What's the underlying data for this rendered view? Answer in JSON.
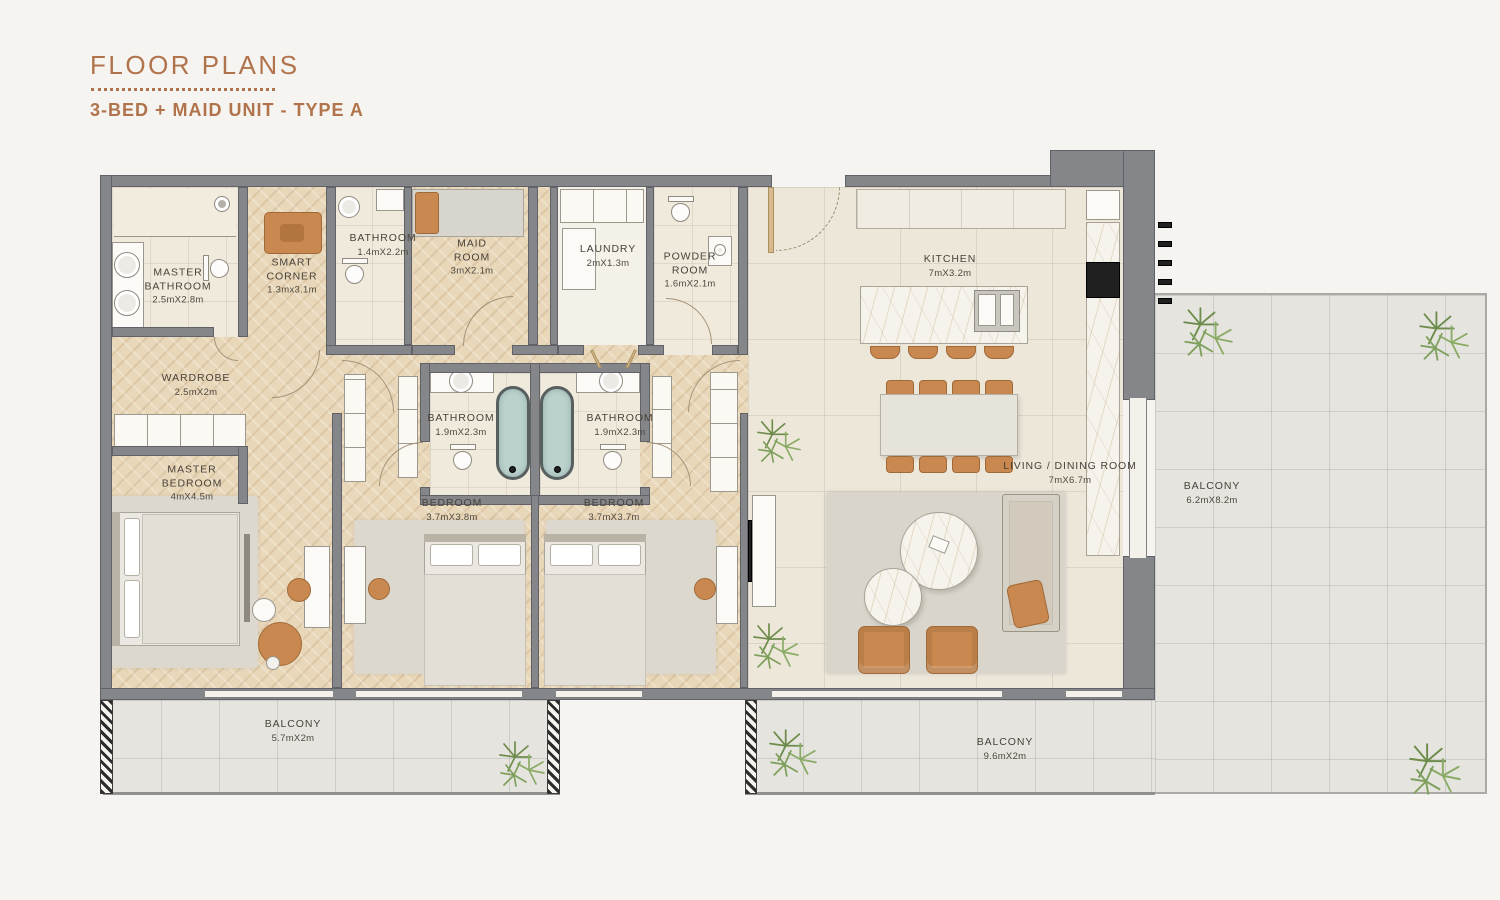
{
  "header": {
    "title": "FLOOR PLANS",
    "subtitle": "3-BED + MAID UNIT - TYPE A"
  },
  "floor_plan": {
    "rooms": [
      {
        "id": "master-bathroom",
        "name": "MASTER BATHROOM",
        "dims": "2.5mX2.8m"
      },
      {
        "id": "smart-corner",
        "name": "SMART CORNER",
        "dims": "1.3mx3.1m"
      },
      {
        "id": "bathroom-maid",
        "name": "BATHROOM",
        "dims": "1.4mX2.2m"
      },
      {
        "id": "maid-room",
        "name": "MAID ROOM",
        "dims": "3mX2.1m"
      },
      {
        "id": "laundry",
        "name": "LAUNDRY",
        "dims": "2mX1.3m"
      },
      {
        "id": "powder-room",
        "name": "POWDER ROOM",
        "dims": "1.6mX2.1m"
      },
      {
        "id": "kitchen",
        "name": "KITCHEN",
        "dims": "7mX3.2m"
      },
      {
        "id": "wardrobe",
        "name": "WARDROBE",
        "dims": "2.5mX2m"
      },
      {
        "id": "bathroom-1",
        "name": "BATHROOM",
        "dims": "1.9mX2.3m"
      },
      {
        "id": "bathroom-2",
        "name": "BATHROOM",
        "dims": "1.9mX2.3m"
      },
      {
        "id": "master-bedroom",
        "name": "MASTER BEDROOM",
        "dims": "4mX4.5m"
      },
      {
        "id": "bedroom-1",
        "name": "BEDROOM",
        "dims": "3.7mX3.8m"
      },
      {
        "id": "bedroom-2",
        "name": "BEDROOM",
        "dims": "3.7mX3.7m"
      },
      {
        "id": "living-dining",
        "name": "LIVING / DINING ROOM",
        "dims": "7mX6.7m"
      },
      {
        "id": "balcony-right",
        "name": "BALCONY",
        "dims": "6.2mX8.2m"
      },
      {
        "id": "balcony-left",
        "name": "BALCONY",
        "dims": "5.7mX2m"
      },
      {
        "id": "balcony-middle",
        "name": "BALCONY",
        "dims": "9.6mX2m"
      }
    ],
    "colors": {
      "accent": "#b0734c",
      "wall": "#84868a",
      "wood_floor": "#e9d7b9",
      "tile_floor": "#ede7da",
      "balcony_floor": "#e5e4df",
      "furniture_accent": "#c9884f",
      "bathtub": "#bad1cd",
      "plant_green": "#7c9a58",
      "label_text": "#48423a"
    }
  }
}
